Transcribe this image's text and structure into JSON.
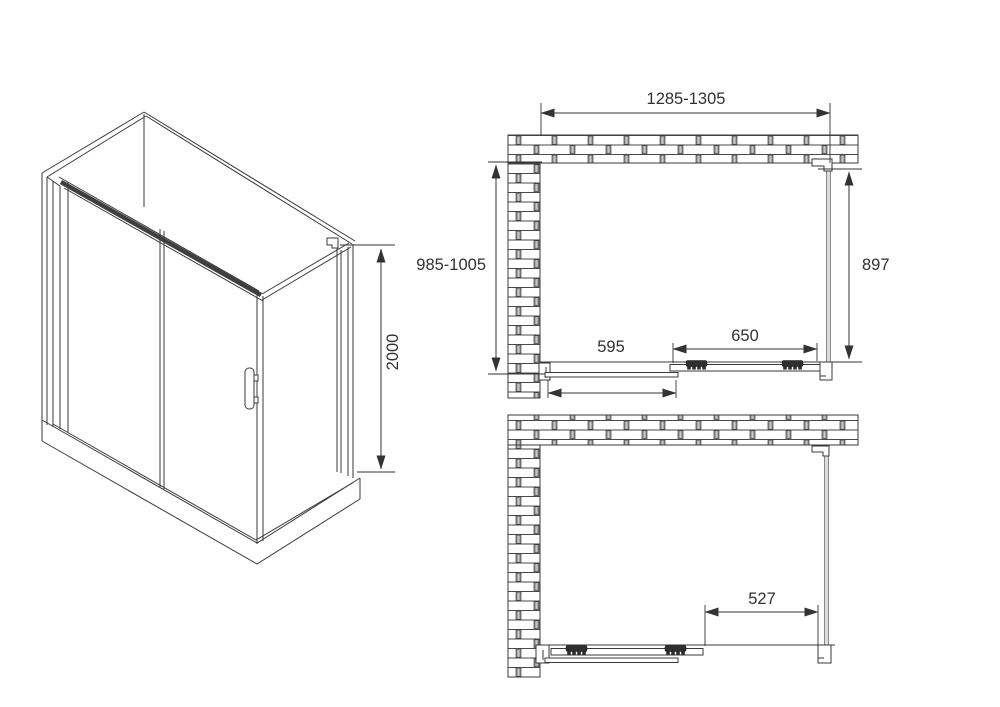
{
  "drawing_type": "shower-enclosure-technical-drawing",
  "colors": {
    "background": "#ffffff",
    "line": "#3a3a3a",
    "dimension_text": "#323232",
    "glass_panel_gray": "#dcdcdc",
    "roller_dark": "#2f2f2f",
    "brick_joint": "#8f8f8f"
  },
  "views": {
    "isometric": {
      "name": "isometric-view",
      "dim_height": "2000"
    },
    "plan_closed": {
      "name": "top-plan-view-door-closed",
      "dim_width": "1285-1305",
      "dim_depth": "985-1005",
      "dim_side_panel": "897",
      "dim_door": "650",
      "dim_fixed_panel": "595"
    },
    "plan_open": {
      "name": "bottom-plan-view-door-open",
      "dim_opening": "527"
    }
  }
}
